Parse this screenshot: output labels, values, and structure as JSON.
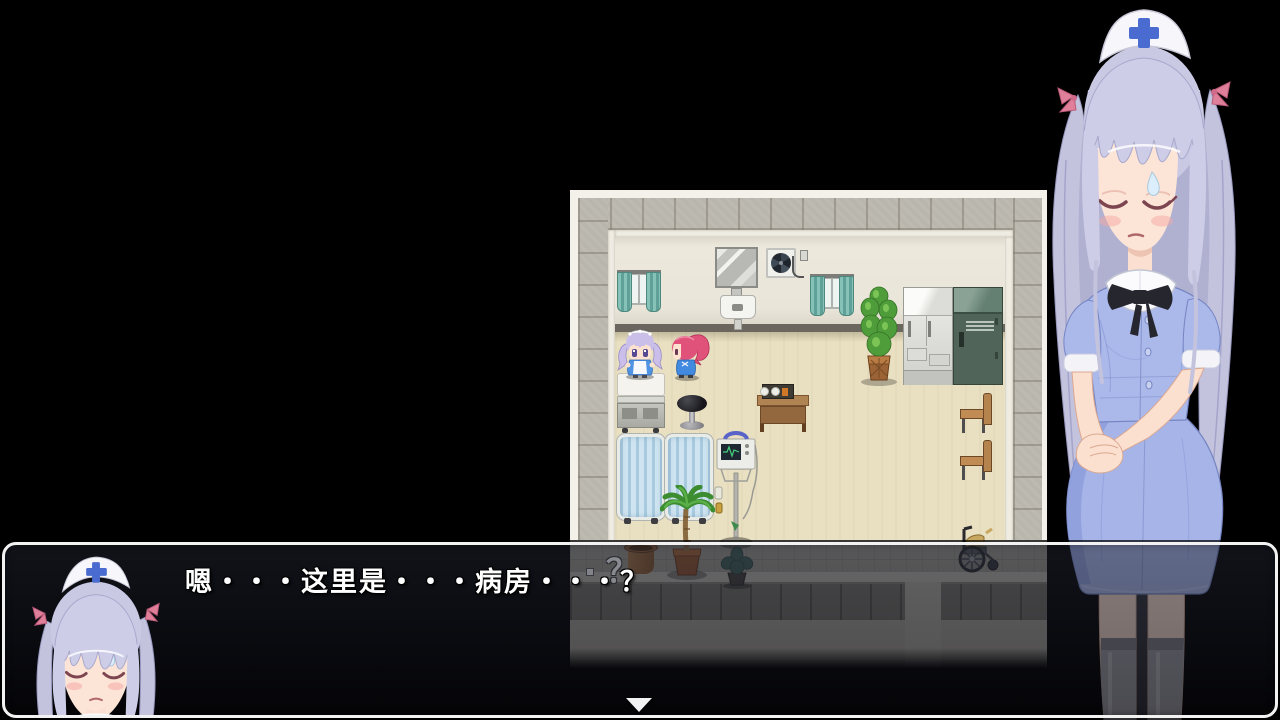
{
  "dialog": {
    "text": "嗯・・・这里是・・・病房・・・？",
    "speaker": "nurse-portrait",
    "advance_cursor": "▼"
  },
  "map": {
    "balloon_marker": "？",
    "room": "hospital-ward",
    "objects": [
      "window-curtains",
      "wall-mirror",
      "exhaust-fan",
      "wall-sink",
      "potted-plant",
      "refrigerator",
      "locker",
      "hospital-bed",
      "stool",
      "meal-table",
      "wooden-chair",
      "wooden-chair",
      "curtained-bed",
      "curtained-bed",
      "palm-plant",
      "medical-monitor-stand",
      "empty-pot",
      "small-plant",
      "wheelchair"
    ],
    "characters": [
      "maid-silver-hair",
      "maid-pink-hair"
    ]
  },
  "colors": {
    "background": "#000000",
    "dialog_border": "#f2f2f2",
    "floor": "#e9dfc1",
    "wall_tiles": "#b9b6ad",
    "curtain_teal": "#6fb0a6",
    "nurse_dress": "#a8b6e8",
    "nurse_hair": "#c9c9e4",
    "cap_cross": "#4a6cd0"
  }
}
